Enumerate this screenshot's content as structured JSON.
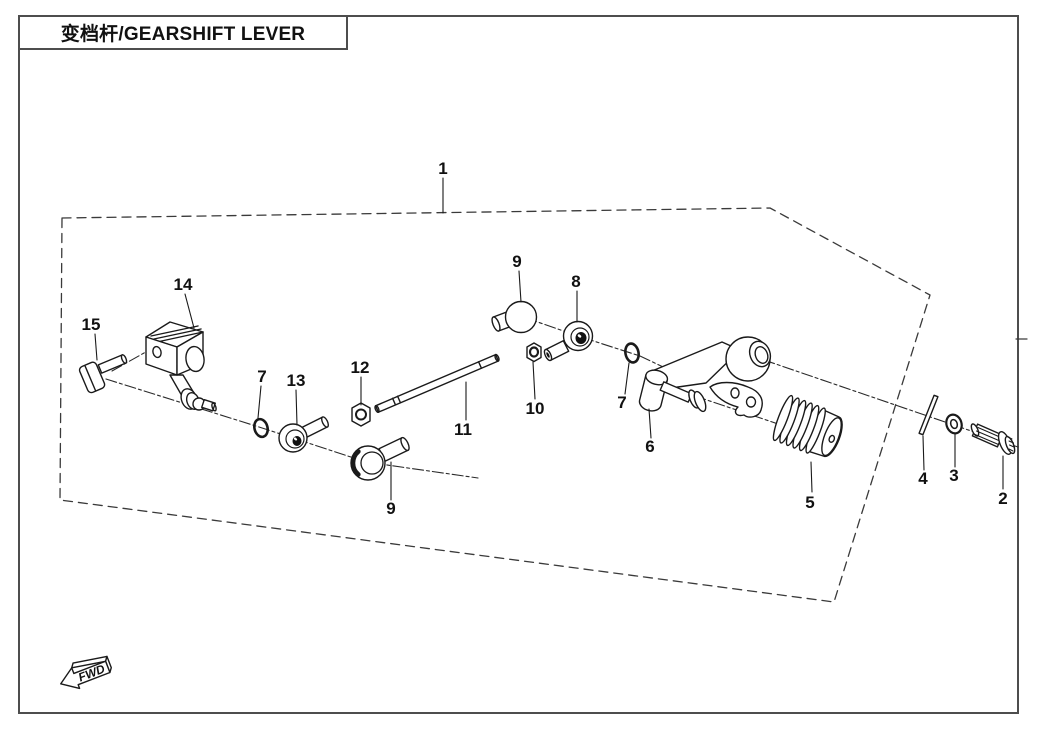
{
  "page": {
    "title": "变档杆/GEARSHIFT LEVER",
    "background": "#ffffff",
    "line_color": "#1a1a1a"
  },
  "diagram": {
    "fwd_label": "FWD",
    "callouts": {
      "c1": {
        "part": "1",
        "label": "1"
      },
      "c2": {
        "part": "2",
        "label": "2"
      },
      "c3": {
        "part": "3",
        "label": "3"
      },
      "c4": {
        "part": "4",
        "label": "4"
      },
      "c5": {
        "part": "5",
        "label": "5"
      },
      "c6": {
        "part": "6",
        "label": "6"
      },
      "c7a": {
        "part": "7",
        "label": "7"
      },
      "c7b": {
        "part": "7",
        "label": "7"
      },
      "c8": {
        "part": "8",
        "label": "8"
      },
      "c9a": {
        "part": "9",
        "label": "9"
      },
      "c9b": {
        "part": "9",
        "label": "9"
      },
      "c10": {
        "part": "10",
        "label": "10"
      },
      "c11": {
        "part": "11",
        "label": "11"
      },
      "c12": {
        "part": "12",
        "label": "12"
      },
      "c13": {
        "part": "13",
        "label": "13"
      },
      "c14": {
        "part": "14",
        "label": "14"
      },
      "c15": {
        "part": "15",
        "label": "15"
      }
    }
  }
}
